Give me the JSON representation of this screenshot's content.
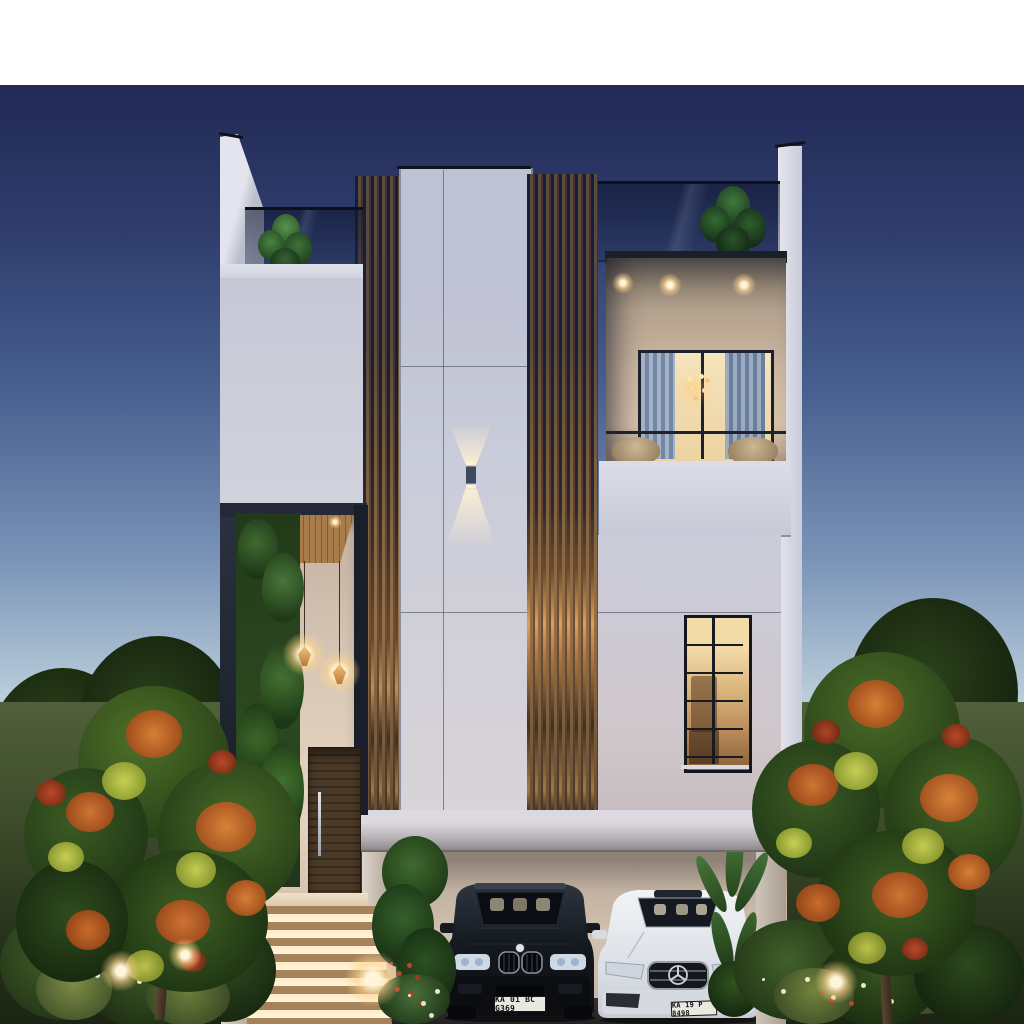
{
  "scene": {
    "description": "Dusk architectural render of a modern two-storey villa with vertical wooden slat facade, glass-railed terraces, lit entry staircase, landscaped garden and two parked cars",
    "time_of_day": "dusk"
  },
  "palette": {
    "sky_top": "#222a55",
    "sky_horizon": "#ccdce4",
    "wall_light": "#dadbe6",
    "wall_mid": "#c7c9d7",
    "carport_wall": "#cfc0b1",
    "wood_slat": "#8a6847",
    "frame_dark": "#242b3a",
    "warm_light": "#ffdf9e",
    "foliage_green": "#3c5c22",
    "foliage_orange": "#d07434",
    "foliage_yellow": "#c6cc52",
    "lawn": "#46552f"
  },
  "vehicles": {
    "suv": {
      "type": "dark SUV",
      "plate": "KA 01 BC G369",
      "body_color": "#171b21"
    },
    "sedan": {
      "type": "white sedan",
      "plate": "KA 19 P 8498",
      "body_color": "#e3e6eb"
    }
  }
}
